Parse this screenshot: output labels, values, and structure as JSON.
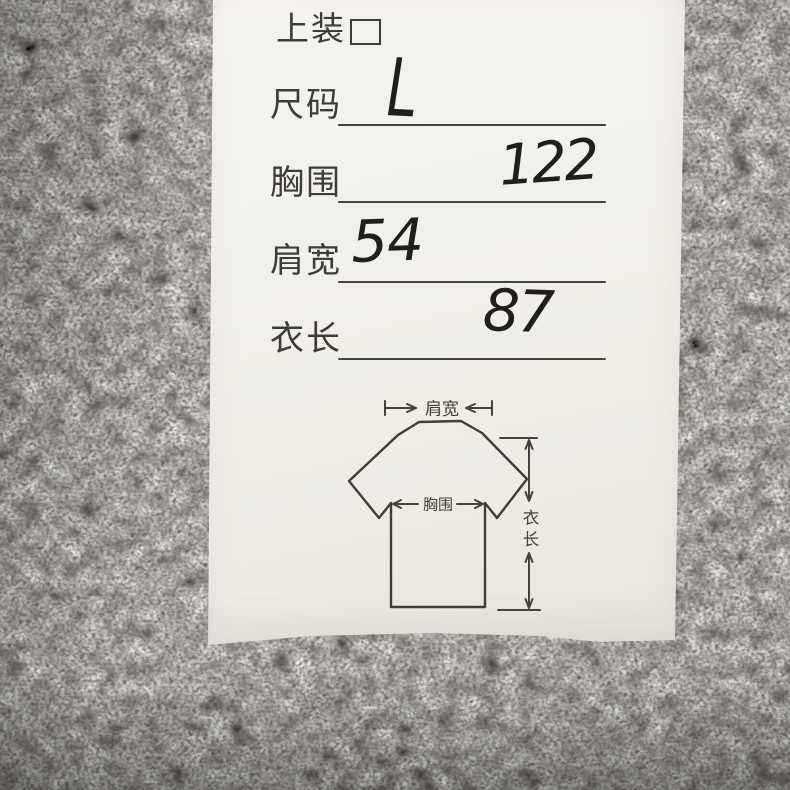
{
  "card": {
    "title": "上装",
    "fields": [
      {
        "label": "尺码",
        "value": "L"
      },
      {
        "label": "胸围",
        "value": "122"
      },
      {
        "label": "肩宽",
        "value": "54"
      },
      {
        "label": "衣长",
        "value": "87"
      }
    ],
    "diagram": {
      "shoulder_label": "肩宽",
      "chest_label": "胸围",
      "length_label": "衣长"
    }
  },
  "colors": {
    "card_paper": "#f2f0ea",
    "printed_ink": "#3e3c37",
    "handwriting_ink": "#201e1a",
    "carpet_gray": "#807d77"
  }
}
